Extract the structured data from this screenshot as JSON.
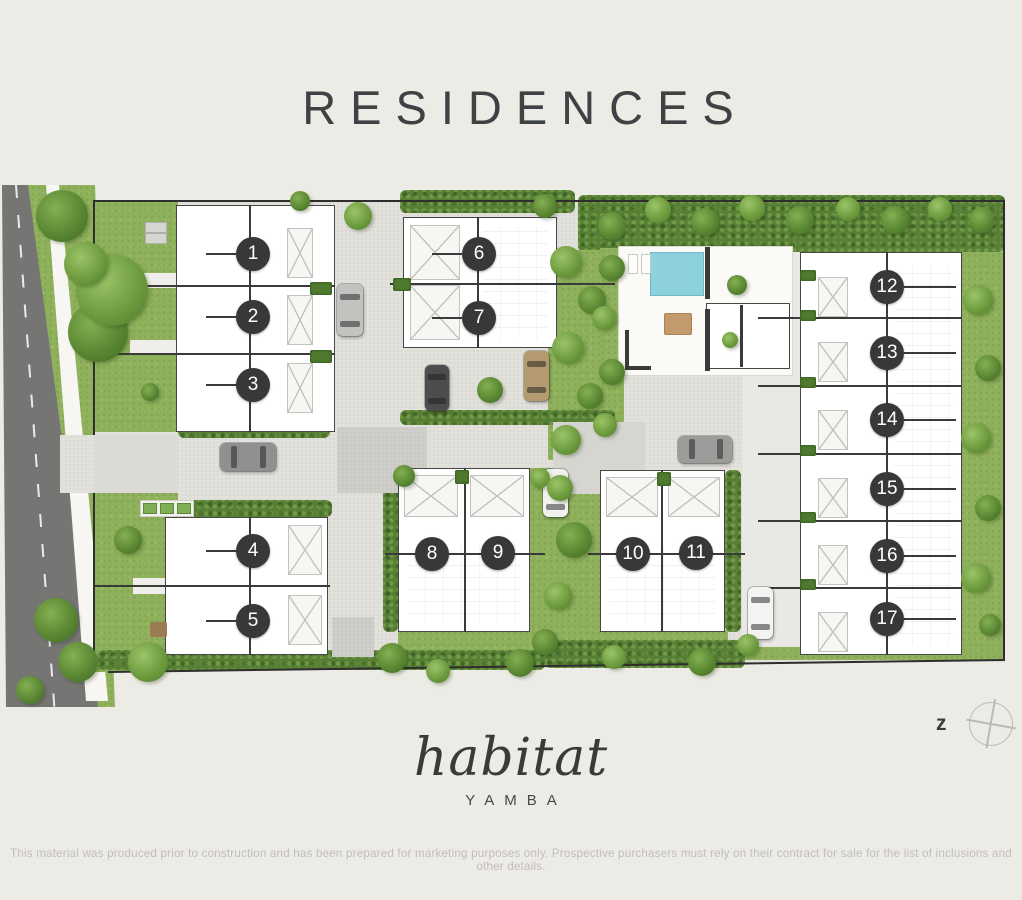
{
  "title": "RESIDENCES",
  "logo": {
    "name": "habitat",
    "location": "YAMBA"
  },
  "disclaimer": "This material was produced prior to construction and has been prepared for marketing purposes only. Prospective purchasers must rely on their contract for sale for the list of inclusions and other details.",
  "compass": {
    "label": "z"
  },
  "colors": {
    "background": "#edebe5",
    "lawn": "#8fb15c",
    "hedge": "#587f36",
    "road": "#757573",
    "footpath": "#f7f6f2",
    "paving": "#e2e1dc",
    "pool": "#8cd1dc",
    "building": "#ffffff",
    "wall": "#3a3a3a",
    "marker_bg": "#38383a",
    "marker_text": "#ffffff"
  },
  "plan": {
    "marker_radius": 17,
    "markers": [
      {
        "id": 1,
        "x": 253,
        "y": 254,
        "leader": "left"
      },
      {
        "id": 2,
        "x": 253,
        "y": 317,
        "leader": "left"
      },
      {
        "id": 3,
        "x": 253,
        "y": 385,
        "leader": "left"
      },
      {
        "id": 4,
        "x": 253,
        "y": 551,
        "leader": "left"
      },
      {
        "id": 5,
        "x": 253,
        "y": 621,
        "leader": "left"
      },
      {
        "id": 6,
        "x": 479,
        "y": 254,
        "leader": "left"
      },
      {
        "id": 7,
        "x": 479,
        "y": 318,
        "leader": "left"
      },
      {
        "id": 8,
        "x": 432,
        "y": 554,
        "leader": null
      },
      {
        "id": 9,
        "x": 498,
        "y": 553,
        "leader": null
      },
      {
        "id": 10,
        "x": 633,
        "y": 554,
        "leader": null
      },
      {
        "id": 11,
        "x": 696,
        "y": 553,
        "leader": null
      },
      {
        "id": 12,
        "x": 887,
        "y": 287,
        "leader": "right"
      },
      {
        "id": 13,
        "x": 887,
        "y": 353,
        "leader": "right"
      },
      {
        "id": 14,
        "x": 887,
        "y": 420,
        "leader": "right"
      },
      {
        "id": 15,
        "x": 887,
        "y": 489,
        "leader": "right"
      },
      {
        "id": 16,
        "x": 887,
        "y": 556,
        "leader": "right"
      },
      {
        "id": 17,
        "x": 887,
        "y": 619,
        "leader": "right"
      }
    ],
    "trees": [
      [
        62,
        216,
        26,
        2
      ],
      [
        98,
        332,
        30,
        2
      ],
      [
        112,
        290,
        36,
        1
      ],
      [
        86,
        264,
        22,
        1
      ],
      [
        150,
        392,
        9,
        2
      ],
      [
        56,
        620,
        22,
        2
      ],
      [
        78,
        662,
        20,
        2
      ],
      [
        30,
        690,
        14,
        2
      ],
      [
        148,
        662,
        20,
        1
      ],
      [
        128,
        540,
        14,
        2
      ],
      [
        358,
        216,
        14,
        1
      ],
      [
        300,
        201,
        10,
        2
      ],
      [
        545,
        206,
        12,
        2
      ],
      [
        612,
        226,
        14,
        2
      ],
      [
        658,
        210,
        13,
        1
      ],
      [
        705,
        222,
        14,
        2
      ],
      [
        752,
        208,
        13,
        1
      ],
      [
        800,
        220,
        14,
        2
      ],
      [
        848,
        209,
        12,
        1
      ],
      [
        895,
        220,
        14,
        2
      ],
      [
        940,
        209,
        12,
        1
      ],
      [
        982,
        220,
        13,
        2
      ],
      [
        566,
        262,
        16,
        1
      ],
      [
        592,
        300,
        14,
        2
      ],
      [
        568,
        348,
        16,
        1
      ],
      [
        590,
        396,
        13,
        2
      ],
      [
        566,
        440,
        15,
        1
      ],
      [
        612,
        268,
        13,
        2
      ],
      [
        604,
        318,
        12,
        1
      ],
      [
        612,
        372,
        13,
        2
      ],
      [
        605,
        425,
        12,
        1
      ],
      [
        737,
        285,
        10,
        2
      ],
      [
        730,
        340,
        8,
        1
      ],
      [
        490,
        390,
        13,
        2
      ],
      [
        404,
        476,
        11,
        2
      ],
      [
        540,
        478,
        10,
        1
      ],
      [
        560,
        488,
        13,
        1
      ],
      [
        574,
        540,
        18,
        2
      ],
      [
        558,
        596,
        14,
        1
      ],
      [
        545,
        642,
        13,
        2
      ],
      [
        392,
        658,
        15,
        2
      ],
      [
        438,
        671,
        12,
        1
      ],
      [
        520,
        663,
        14,
        2
      ],
      [
        614,
        657,
        12,
        1
      ],
      [
        702,
        662,
        14,
        2
      ],
      [
        748,
        645,
        11,
        1
      ],
      [
        978,
        300,
        15,
        1
      ],
      [
        988,
        368,
        13,
        2
      ],
      [
        976,
        438,
        15,
        1
      ],
      [
        988,
        508,
        13,
        2
      ],
      [
        976,
        578,
        15,
        1
      ],
      [
        990,
        625,
        11,
        2
      ]
    ],
    "cars": [
      {
        "x": 350,
        "y": 310,
        "dir": "v",
        "len": 52,
        "wid": 26,
        "color": "#c2c2c0"
      },
      {
        "x": 437,
        "y": 388,
        "dir": "v",
        "len": 46,
        "wid": 24,
        "color": "#4d4d4d"
      },
      {
        "x": 536,
        "y": 376,
        "dir": "v",
        "len": 50,
        "wid": 25,
        "color": "#b59a6f"
      },
      {
        "x": 248,
        "y": 457,
        "dir": "h",
        "len": 56,
        "wid": 28,
        "color": "#909090"
      },
      {
        "x": 555,
        "y": 493,
        "dir": "v",
        "len": 48,
        "wid": 25,
        "color": "#f1f1ef"
      },
      {
        "x": 705,
        "y": 449,
        "dir": "h",
        "len": 54,
        "wid": 27,
        "color": "#9c9c9a"
      },
      {
        "x": 760,
        "y": 613,
        "dir": "v",
        "len": 52,
        "wid": 25,
        "color": "#f3f3f1"
      }
    ],
    "hedge_bars": [
      {
        "x": 310,
        "y": 282,
        "w": 22,
        "h": 13
      },
      {
        "x": 310,
        "y": 350,
        "w": 22,
        "h": 13
      },
      {
        "x": 393,
        "y": 278,
        "w": 18,
        "h": 13
      },
      {
        "x": 455,
        "y": 470,
        "w": 14,
        "h": 14
      },
      {
        "x": 657,
        "y": 472,
        "w": 14,
        "h": 14
      },
      {
        "x": 800,
        "y": 270,
        "w": 16,
        "h": 11
      },
      {
        "x": 800,
        "y": 310,
        "w": 16,
        "h": 11
      },
      {
        "x": 800,
        "y": 377,
        "w": 16,
        "h": 11
      },
      {
        "x": 800,
        "y": 445,
        "w": 16,
        "h": 11
      },
      {
        "x": 800,
        "y": 512,
        "w": 16,
        "h": 11
      },
      {
        "x": 800,
        "y": 579,
        "w": 16,
        "h": 11
      }
    ],
    "pool": {
      "x": 650,
      "y": 252,
      "w": 54,
      "h": 44
    }
  }
}
